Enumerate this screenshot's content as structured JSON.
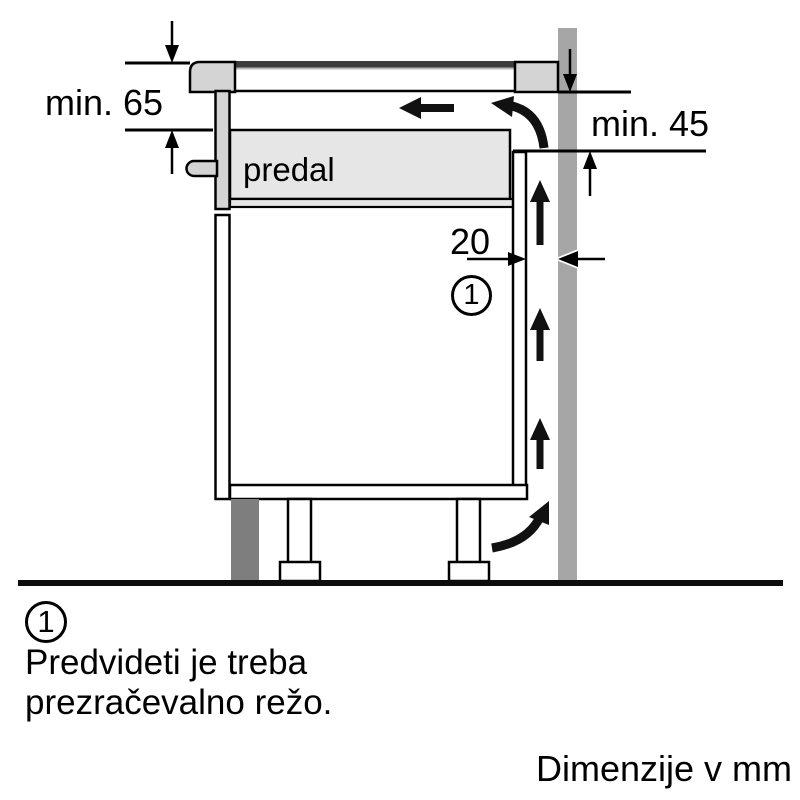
{
  "diagram": {
    "labels": {
      "clearance_left": "min. 65",
      "clearance_right": "min. 45",
      "rear_gap": "20",
      "drawer": "predal",
      "callout": "1"
    },
    "colors": {
      "wall": "#a6a6a6",
      "plinth": "#7e7e7e",
      "trim": "#d4d4d4",
      "drawer_fill": "#e6e6e6",
      "glass": "#3c3c3c",
      "glass_highlight": "#b8b8b8",
      "line": "#000000",
      "arrow": "#111111",
      "floor": "#0d0d0d"
    }
  },
  "legend": {
    "callout": "1",
    "note_line_1": "Predvideti je treba",
    "note_line_2": "prezračevalno režo.",
    "units": "Dimenzije v mm"
  }
}
